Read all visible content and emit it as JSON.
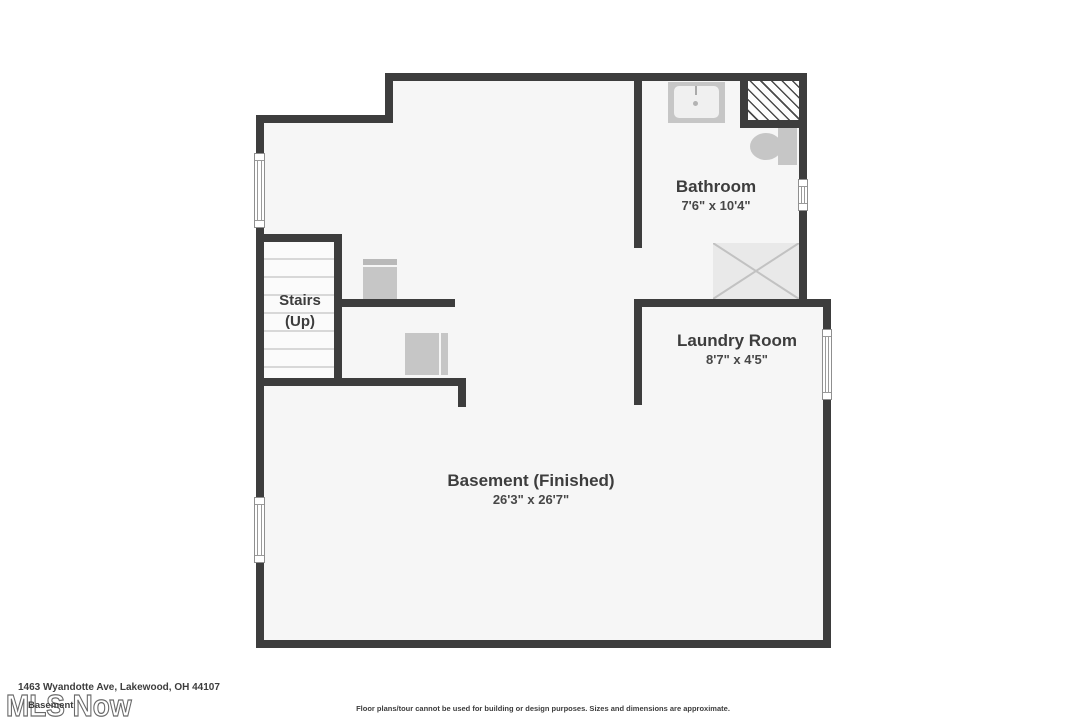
{
  "rooms": {
    "bathroom": {
      "name": "Bathroom",
      "dims": "7'6\" x 10'4\""
    },
    "laundry": {
      "name": "Laundry Room",
      "dims": "8'7\" x 4'5\""
    },
    "stairs": {
      "name": "Stairs",
      "direction": "(Up)"
    },
    "basement": {
      "name": "Basement (Finished)",
      "dims": "26'3\" x 26'7\""
    }
  },
  "fixtures": {
    "sink": "sink-icon",
    "toilet": "toilet-icon",
    "shower": "shower-icon",
    "chimney_chase": "hatched-chase-icon",
    "furnace": "furnace-icon",
    "washer_dryer": "washer-dryer-icon",
    "windows": "window-icon",
    "stairs_treads": "stairs-treads-icon"
  },
  "footer": {
    "address": "1463 Wyandotte Ave, Lakewood, OH 44107",
    "floor_label": "Basement",
    "watermark": "MLS Now",
    "disclaimer": "Floor plans/tour cannot be used for building or design purposes. Sizes and dimensions are approximate."
  },
  "colors": {
    "wall": "#3d3d3d",
    "floor": "#f6f6f6",
    "fixture": "#c6c6c6",
    "background": "#ffffff",
    "text": "#3d3d3d"
  }
}
